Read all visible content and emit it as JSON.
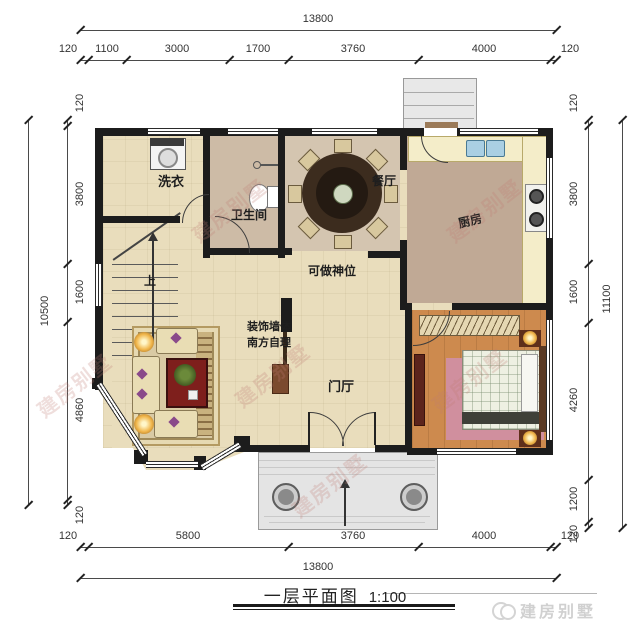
{
  "title_block": {
    "title": "一层平面图",
    "scale": "1:100"
  },
  "logo": {
    "text": "建房别墅"
  },
  "watermark": {
    "text": "建房别墅"
  },
  "dimensions": {
    "top": {
      "total": "13800",
      "segments": [
        "120",
        "1100",
        "3000",
        "1700",
        "3760",
        "4000",
        "120"
      ]
    },
    "bottom": {
      "total": "13800",
      "segments": [
        "120",
        "5800",
        "3760",
        "4000",
        "120"
      ]
    },
    "left": {
      "total": "10500",
      "segments": [
        "120",
        "3800",
        "1600",
        "4860",
        "120"
      ]
    },
    "right": {
      "total": "11100",
      "segments": [
        "120",
        "3800",
        "1600",
        "4260",
        "1200",
        "120"
      ]
    }
  },
  "rooms": {
    "laundry": "洗衣",
    "bathroom": "卫生间",
    "dining": "餐厅",
    "kitchen": "厨房",
    "foyer": "门厅"
  },
  "annotations": {
    "shrine": "可做神位",
    "decor_wall_line1": "装饰墙体",
    "decor_wall_line2": "南方自理",
    "stairs_up": "上"
  },
  "colors": {
    "wall": "#1c1c1c",
    "floor_main": "#e9ddbc",
    "floor_dining": "#d4c5b0",
    "floor_bath": "#cdbba6",
    "floor_kitchen": "#c0a995",
    "floor_bedroom": "#cd8a4e",
    "rug_pink": "#d08f9e",
    "table_red": "#7e1f1c",
    "porch_gray": "#e4e4e4"
  }
}
